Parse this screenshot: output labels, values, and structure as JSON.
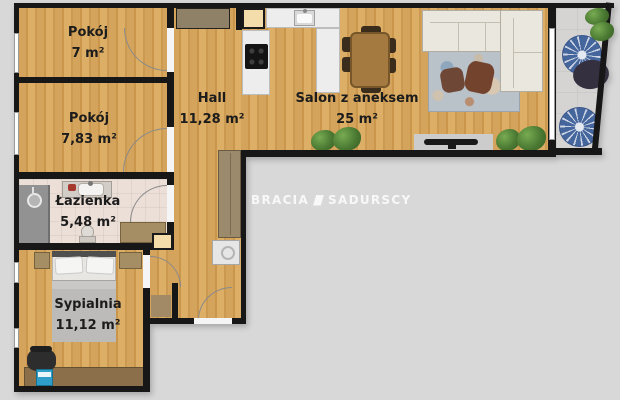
{
  "watermark": {
    "brand_left": "BRACIA",
    "brand_right": "SADURSCY"
  },
  "rooms": [
    {
      "name": "Pokój",
      "area": "7 m²"
    },
    {
      "name": "Pokój",
      "area": "7,83 m²"
    },
    {
      "name": "Hall",
      "area": "11,28 m²"
    },
    {
      "name": "Salon z aneksem",
      "area": "25 m²"
    },
    {
      "name": "Łazienka",
      "area": "5,48 m²"
    },
    {
      "name": "Sypialnia",
      "area": "11,12 m²"
    }
  ],
  "colors": {
    "background": "#d8d8d8",
    "wall": "#171717",
    "wood_floor": "#d2a057",
    "bathroom_tile": "#ecdfd8",
    "balcony_tile": "#d5d4d2",
    "label_text": "#1c1c1c",
    "plant_green": "#4b7a33",
    "balcony_pouf_blue": "#45659d"
  }
}
